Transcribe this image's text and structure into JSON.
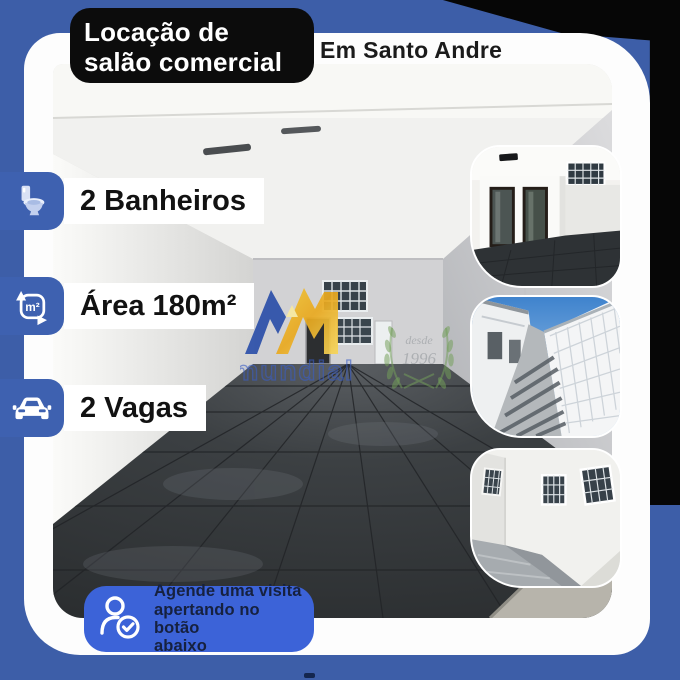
{
  "header": {
    "title_line1": "Locação de",
    "title_line2": "salão comercial",
    "location": "Em Santo Andre"
  },
  "features": [
    {
      "icon": "toilet-icon",
      "label": "2 Banheiros"
    },
    {
      "icon": "area-m2-icon",
      "icon_text": "m²",
      "label": "Área 180m²"
    },
    {
      "icon": "car-icon",
      "label": "2 Vagas"
    }
  ],
  "watermark": {
    "brand": "mundial",
    "badge_line1": "desde",
    "badge_line2": "1996"
  },
  "cta": {
    "icon": "person-check-icon",
    "line1": "Agende uma visita",
    "line2": "apertando no botão",
    "line3": "abaixo"
  },
  "photos": {
    "main": "empty-commercial-hall-dark-floor",
    "thumb1": "interior-with-two-dark-doors",
    "thumb2": "side-corridor-with-lattice-fence",
    "thumb3": "back-courtyard-barred-windows"
  },
  "colors": {
    "background_blue": "#3d5ea8",
    "chip_blue": "#3e61b0",
    "cta_blue": "#3c63d8",
    "cta_text": "#16213f",
    "title_box_black": "#0c0c0c",
    "logo_blue": "#2b4fa9",
    "logo_gold": "#f0b92c",
    "laurel_green": "#74a05a"
  }
}
